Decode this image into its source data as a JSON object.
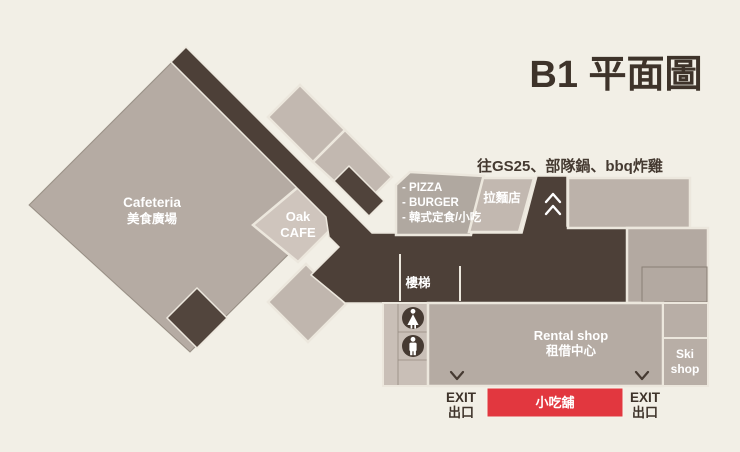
{
  "title": "B1 平面圖",
  "note": "往GS25、部隊鍋、bbq炸雞",
  "rooms": {
    "cafeteria": {
      "en": "Cafeteria",
      "zh": "美食廣場"
    },
    "oak_cafe": {
      "line1": "Oak",
      "line2": "CAFE"
    },
    "food_stalls": {
      "line1": "- PIZZA",
      "line2": "- BURGER",
      "line3": "- 韓式定食/小吃"
    },
    "ramen": "拉麵店",
    "stairs": "樓梯",
    "rental": {
      "en": "Rental shop",
      "zh": "租借中心"
    },
    "ski": {
      "line1": "Ski",
      "line2": "shop"
    },
    "snack_bar": "小吃舖"
  },
  "exits": {
    "en": "EXIT",
    "zh": "出口"
  },
  "icons": {
    "up_passage": "double-chevron-up",
    "exit_left": "chevron-down",
    "exit_right": "chevron-down",
    "women_restroom": "woman-figure",
    "men_restroom": "man-figure"
  },
  "colors": {
    "background": "#f2efe6",
    "room": "#b5aba3",
    "room_light": "#cbc1b9",
    "corridor": "#4d4038",
    "accent_red": "#e2373f",
    "text_dark": "#3e332a",
    "text_light": "#ffffff"
  }
}
